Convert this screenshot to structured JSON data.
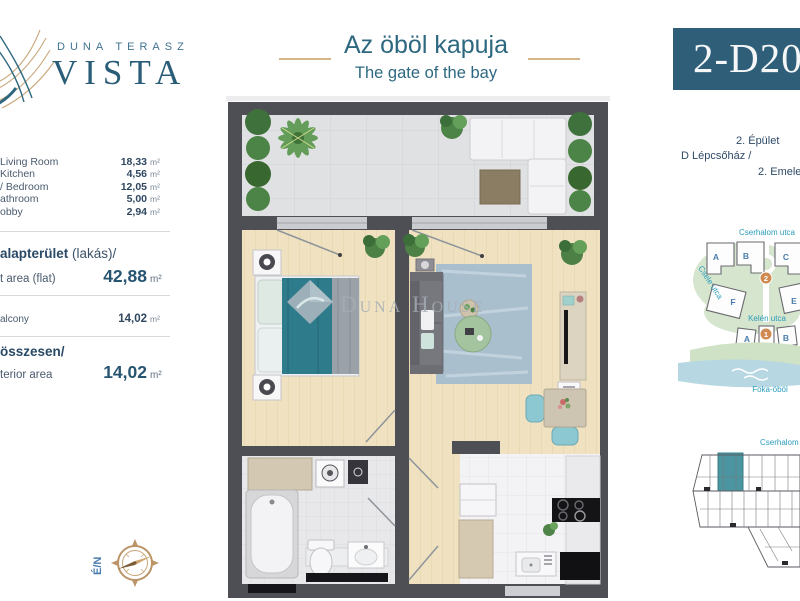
{
  "brand": {
    "top": "DUNA TERASZ",
    "name": "VISTA"
  },
  "title": {
    "hu": "Az öböl kapuja",
    "en": "The gate of the bay"
  },
  "unit": {
    "code": "2-D20"
  },
  "areas": {
    "rooms": [
      {
        "label": "Living Room",
        "value": "18,33",
        "unit": "m²"
      },
      {
        "label": "Kitchen",
        "value": "4,56",
        "unit": "m²"
      },
      {
        "label": "/ Bedroom",
        "value": "12,05",
        "unit": "m²"
      },
      {
        "label": "athroom",
        "value": "5,00",
        "unit": "m²"
      },
      {
        "label": "obby",
        "value": "2,94",
        "unit": "m²"
      }
    ],
    "net": {
      "label_hu_bold": "alapterület",
      "label_hu_rest": " (lakás)/",
      "label_en": "t area (flat)",
      "value": "42,88",
      "unit": "m²"
    },
    "balcony": {
      "label": "alcony",
      "value": "14,02",
      "unit": "m²"
    },
    "total": {
      "label_hu": "összesen/",
      "label_en": "terior area",
      "value": "14,02",
      "unit": "m²"
    }
  },
  "building": {
    "line1": "2. Épület",
    "line2": "D Lépcsőház /",
    "line3": "2. Emelet"
  },
  "sitemap": {
    "street_top": "Cserhalom utca",
    "street_left": "Csele utca",
    "street_mid": "Kelén utca",
    "bay": "Foka-öböl",
    "blocks_top": [
      "A",
      "B",
      "C"
    ],
    "blocks_mid": [
      "F",
      "E"
    ],
    "blocks_bottom": [
      "A",
      "B"
    ],
    "phase_top": "2",
    "phase_bottom": "1"
  },
  "strip": {
    "street": "Cserhalom utca"
  },
  "compass": {
    "label": "É/N"
  },
  "watermark": {
    "text": "Duna House"
  },
  "colors": {
    "brand_teal": "#2e5f79",
    "gold": "#c9a87c",
    "map_teal": "#2a9cba",
    "accent_orange": "#cf8b52",
    "unit_highlight": "#4a95a0"
  }
}
